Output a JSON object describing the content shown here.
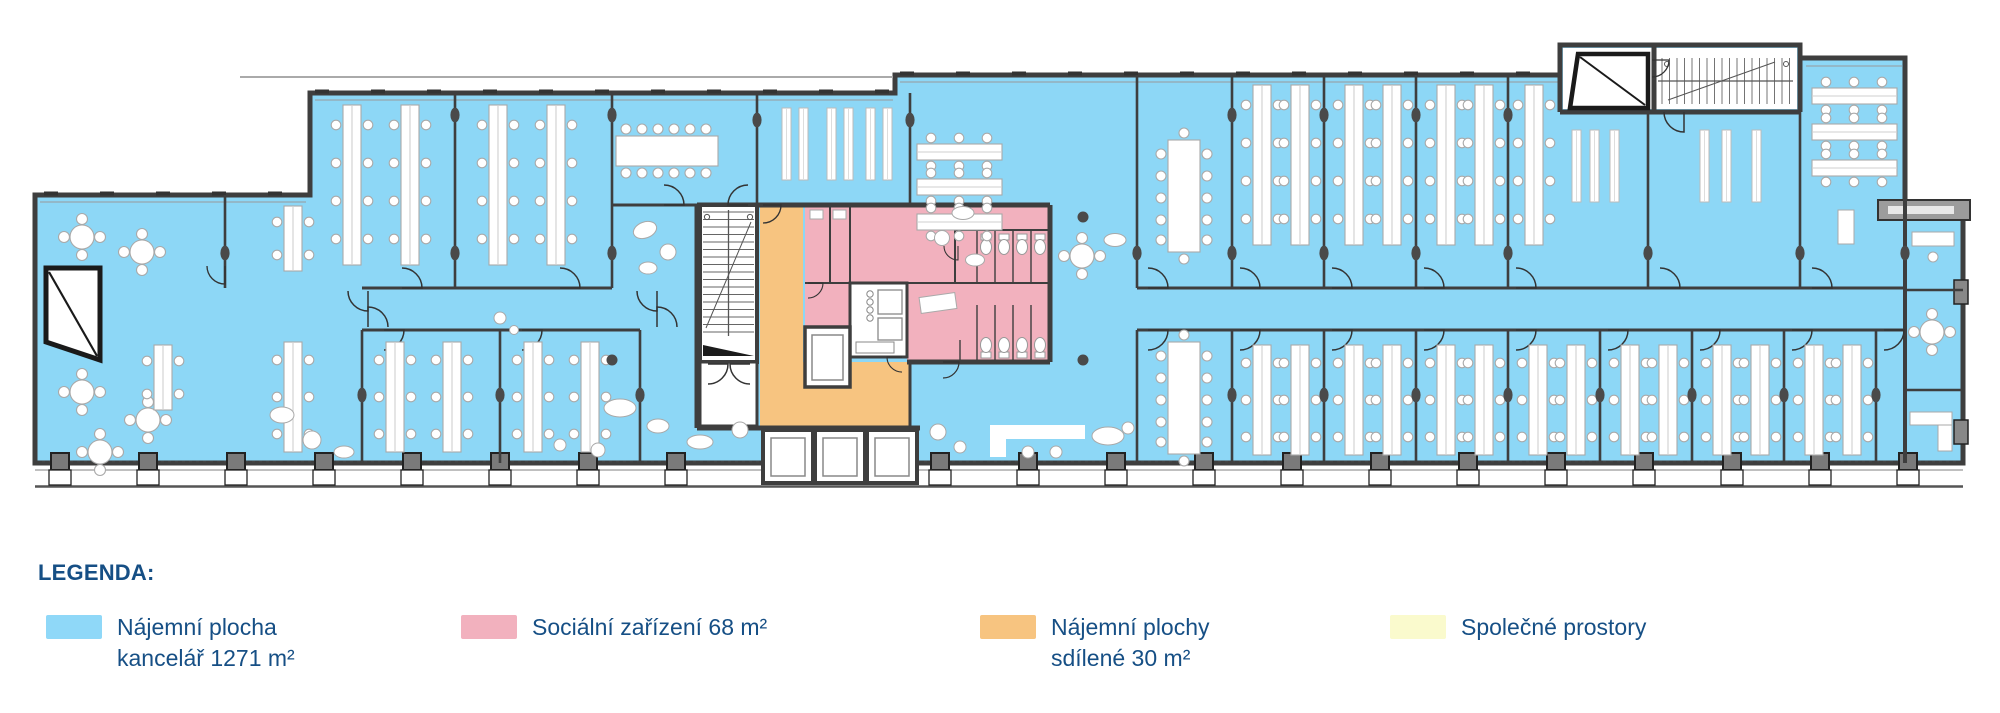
{
  "legend": {
    "title": "LEGENDA:",
    "text_color": "#164F85",
    "items": [
      {
        "id": "rental-office-area",
        "color": "#8FD8F8",
        "line1": "Nájemní plocha",
        "line2": "kancelář 1271 m²"
      },
      {
        "id": "sanitary-facilities",
        "color": "#F2B1BE",
        "line1": "Sociální zařízení 68 m²",
        "line2": ""
      },
      {
        "id": "shared-rental-areas",
        "color": "#F7C480",
        "line1": "Nájemní plochy",
        "line2": "sdílené 30 m²"
      },
      {
        "id": "common-areas",
        "color": "#FAFACD",
        "line1": "Společné prostory",
        "line2": ""
      }
    ]
  },
  "plan": {
    "colors": {
      "office": "#8DD7F6",
      "sanitary": "#F2B1BE",
      "shared": "#F7C480",
      "common": "#FAFACD",
      "wall": "#3E3E3E"
    }
  }
}
